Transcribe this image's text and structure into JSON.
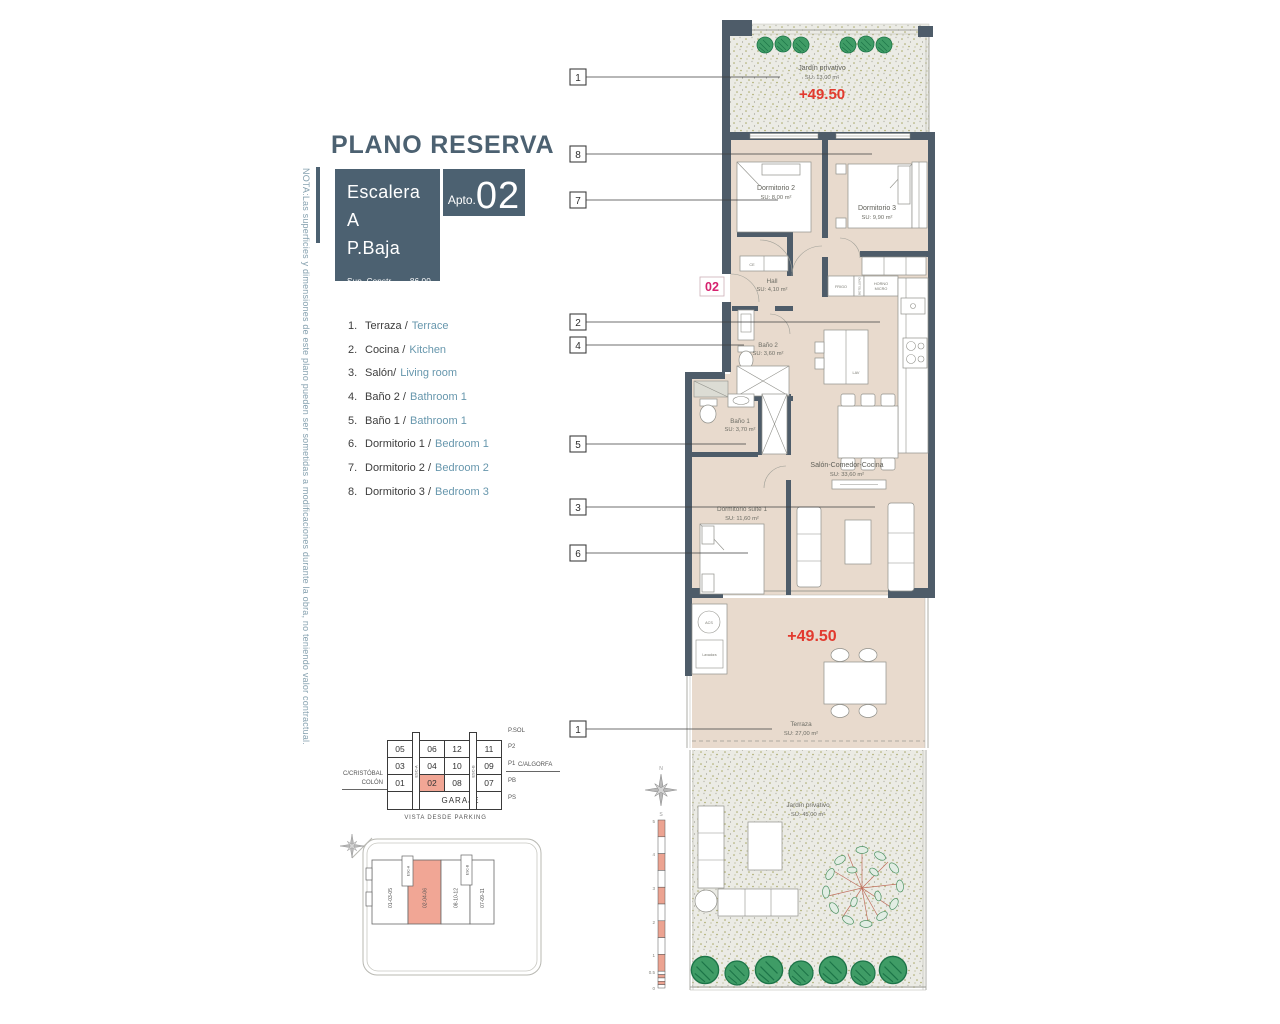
{
  "note_vertical": "NOTA:Las superficies y dimensiones de este plano pueden ser sometidas a modificaciones durante la obra, no teniendo valor contractual.",
  "header": {
    "title": "PLANO RESERVA",
    "stair_line1": "Escalera A",
    "stair_line2": "P.Baja",
    "sup_constr": "Sup. Constr........86,00 m²",
    "sup_terrazas": "Sup.Terrazas......85,00 m²",
    "apto_label": "Apto.",
    "apto_number": "02"
  },
  "legend": {
    "items": [
      {
        "num": "1.",
        "es": "Terraza /",
        "en": "Terrace"
      },
      {
        "num": "2.",
        "es": "Cocina /",
        "en": "Kitchen"
      },
      {
        "num": "3.",
        "es": "Salón/",
        "en": "Living room"
      },
      {
        "num": "4.",
        "es": "Baño 2 /",
        "en": "Bathroom 1"
      },
      {
        "num": "5.",
        "es": "Baño 1 /",
        "en": "Bathroom 1"
      },
      {
        "num": "6.",
        "es": "Dormitorio 1 /",
        "en": "Bedroom 1"
      },
      {
        "num": "7.",
        "es": "Dormitorio 2 /",
        "en": "Bedroom 2"
      },
      {
        "num": "8.",
        "es": "Dormitorio 3 /",
        "en": "Bedroom 3"
      }
    ]
  },
  "garage": {
    "rows": [
      {
        "label": "P2",
        "cells": [
          "05",
          "06",
          "12",
          "11"
        ]
      },
      {
        "label": "P1",
        "cells": [
          "03",
          "04",
          "10",
          "09"
        ]
      },
      {
        "label": "PB",
        "cells": [
          "01",
          "02",
          "08",
          "07"
        ]
      }
    ],
    "garaje": "GARAJE",
    "esc_a": "ESC-A",
    "esc_b": "ESC-B",
    "top_right": "P.SOL",
    "bottom_right": "PS",
    "street_left_1": "C/CRISTÓBAL",
    "street_left_2": "COLÓN",
    "street_right": "C/ALGORFA",
    "caption": "VISTA DESDE PARKING"
  },
  "site": {
    "blocks": [
      "01-03-05",
      "02-04-06",
      "08-10-12",
      "07-09-11"
    ],
    "esc_a": "ESC-A",
    "esc_b": "ESC-B"
  },
  "plan": {
    "callouts": [
      "1",
      "8",
      "7",
      "2",
      "4",
      "5",
      "3",
      "6",
      "1"
    ],
    "door_number": "02",
    "elevation_top": "+49.50",
    "elevation_terrace": "+49.50",
    "rooms": {
      "jardin_top": {
        "name": "Jardín privativo",
        "su": "SU: 13,00 m²"
      },
      "dorm2": {
        "name": "Dormitorio 2",
        "su": "SU: 8,00 m²"
      },
      "dorm3": {
        "name": "Dormitorio 3",
        "su": "SU: 9,90 m²"
      },
      "hall": {
        "name": "Hall",
        "su": "SU: 4,10 m²"
      },
      "bano2": {
        "name": "Baño 2",
        "su": "SU: 3,60 m²"
      },
      "bano1": {
        "name": "Baño 1",
        "su": "SU: 3,70 m²"
      },
      "salon": {
        "name": "Salón-Comedor-Cocina",
        "su": "SU: 33,60 m²"
      },
      "suite": {
        "name": "Dormitorio suite 1",
        "su": "SU: 11,60 m²"
      },
      "terraza": {
        "name": "Terraza",
        "su": "SU: 27,00 m²"
      },
      "jardin_bottom": {
        "name": "Jardín privativo",
        "su": "SU: 45,00 m²"
      }
    },
    "fixtures": {
      "ce": "CE",
      "frigo": "FRIGO",
      "botellero": "BOTELLERO",
      "horno": "HORNO",
      "micro": "MICRO",
      "lav": "LAV",
      "acs": "ACS",
      "lavadora": "Lavadora"
    },
    "scale_labels": [
      "5",
      "4",
      "3",
      "2",
      "1",
      "0.5",
      "0"
    ],
    "compass_n": "N",
    "compass_s": "S"
  },
  "colors": {
    "slate": "#4c6171",
    "wall": "#4e5c69",
    "floor": "#e8dacd",
    "red": "#e23a2e",
    "magenta": "#d6216e",
    "salmon": "#f1a695",
    "legend_en": "#6797ad",
    "green": "#3f9c66"
  }
}
